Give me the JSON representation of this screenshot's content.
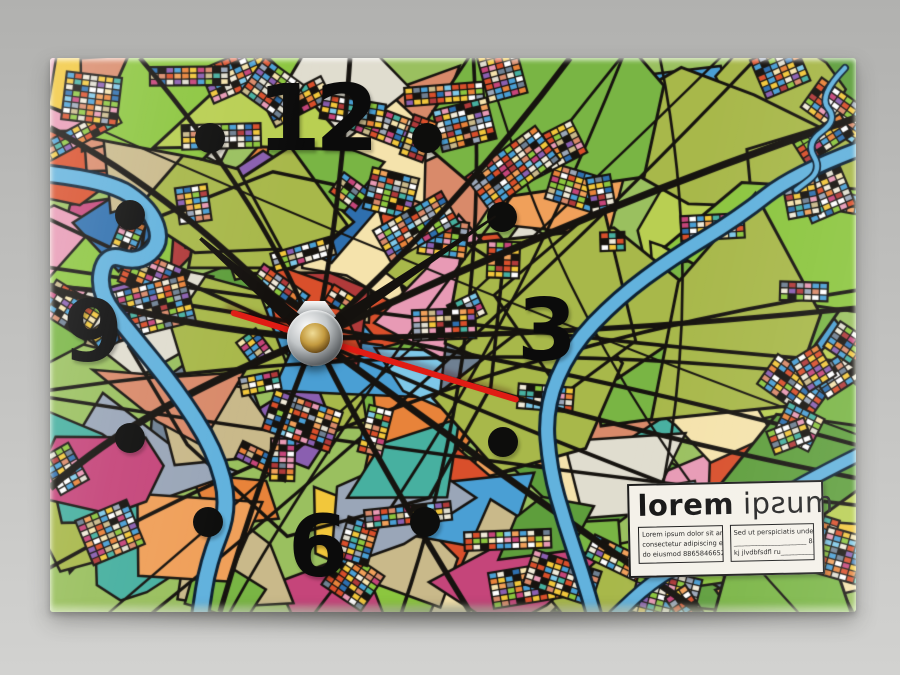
{
  "scene": {
    "description": "Product photo of a rectangular glass desk clock printed with an abstract multicolour lorem-ipsum city map",
    "background_top": "#b1b1af",
    "background_bottom": "#d2d2d0"
  },
  "clock": {
    "numerals": {
      "twelve": "12",
      "three": "3",
      "six": "6",
      "nine": "9"
    },
    "numeral_color": "#0b0b0b",
    "marker_color": "#0d0d0c",
    "markers": [
      {
        "pos": "1-oclock",
        "x": 377,
        "y": 80
      },
      {
        "pos": "2-oclock",
        "x": 452,
        "y": 159
      },
      {
        "pos": "4-oclock",
        "x": 453,
        "y": 384
      },
      {
        "pos": "5-oclock",
        "x": 375,
        "y": 464
      },
      {
        "pos": "7-oclock",
        "x": 158,
        "y": 464
      },
      {
        "pos": "8-oclock",
        "x": 80,
        "y": 380
      },
      {
        "pos": "10-oclock",
        "x": 80,
        "y": 157
      },
      {
        "pos": "11-oclock",
        "x": 160,
        "y": 80
      }
    ],
    "time": {
      "hour_angle_deg": -49,
      "minute_angle_deg": 56,
      "second_angle_deg": 107
    },
    "hand_color": "#14110e",
    "second_hand_color": "#e01c14"
  },
  "label_card": {
    "title_bold": "lorem",
    "title_light": "ipƨum",
    "left_box_lines": [
      "Lorem ipsum dolor sit amet,",
      "consectetur adipiscing elit, sed",
      "do eiusmod 88658466521 //"
    ],
    "right_box_lines": [
      "Sed ut perspiciatis unde omnis",
      "______________________ 88",
      "kj  jlvdbfsdfl ru___________ ."
    ]
  },
  "map": {
    "base_color": "#9ac05f",
    "road_color": "#16130f",
    "river_fill": "#62b2dd",
    "river_outline": "#0d2133",
    "palette": [
      "#d94f2b",
      "#e8833a",
      "#f2c73b",
      "#f5e3ac",
      "#c5457a",
      "#e89ab5",
      "#8a5fb0",
      "#4a9fd4",
      "#7ec8e8",
      "#2e6fae",
      "#47b0a0",
      "#c9b98a",
      "#6f8092",
      "#b03a3a",
      "#e0ddcf",
      "#d98a6a",
      "#9aa6b8",
      "#f0a05a"
    ],
    "greens": [
      "#8cc63f",
      "#5e9e3c",
      "#a8b84a",
      "#79b544",
      "#b9cf52"
    ],
    "tile_extra": [
      "#ffffff",
      "#f0ead8",
      "#f2c73b",
      "#d94f2b",
      "#4a9fd4",
      "#8cc63f"
    ]
  }
}
